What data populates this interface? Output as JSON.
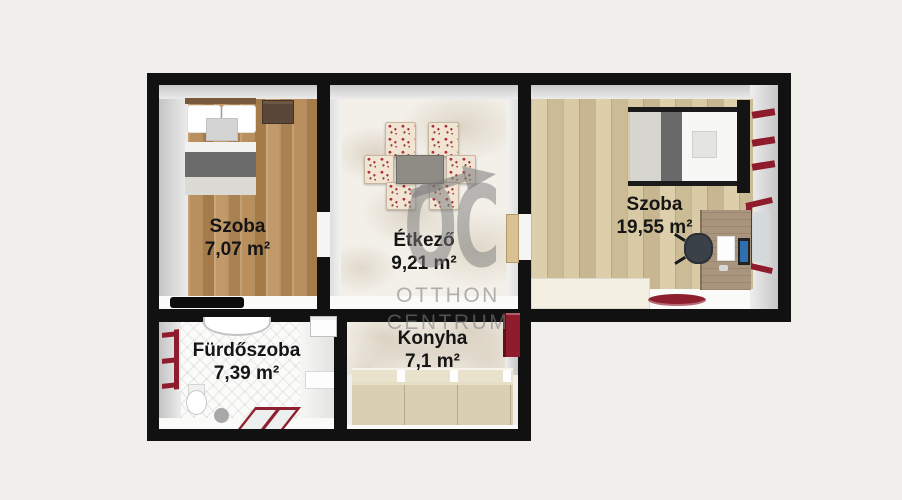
{
  "floorplan": {
    "background_color": "#f0efeb",
    "wall_color": "#111111",
    "accent_red": "#8e1c2c"
  },
  "rooms": {
    "bedroom_small": {
      "name": "Szoba",
      "area": "7,07 m²"
    },
    "dining": {
      "name": "Étkező",
      "area": "9,21 m²"
    },
    "bedroom_large": {
      "name": "Szoba",
      "area": "19,55 m²"
    },
    "bathroom": {
      "name": "Fürdőszoba",
      "area": "7,39 m²"
    },
    "kitchen": {
      "name": "Konyha",
      "area": "7,1 m²"
    }
  },
  "watermark": {
    "logo": "OC",
    "line1": "OTTHON",
    "line2": "CENTRUM"
  }
}
